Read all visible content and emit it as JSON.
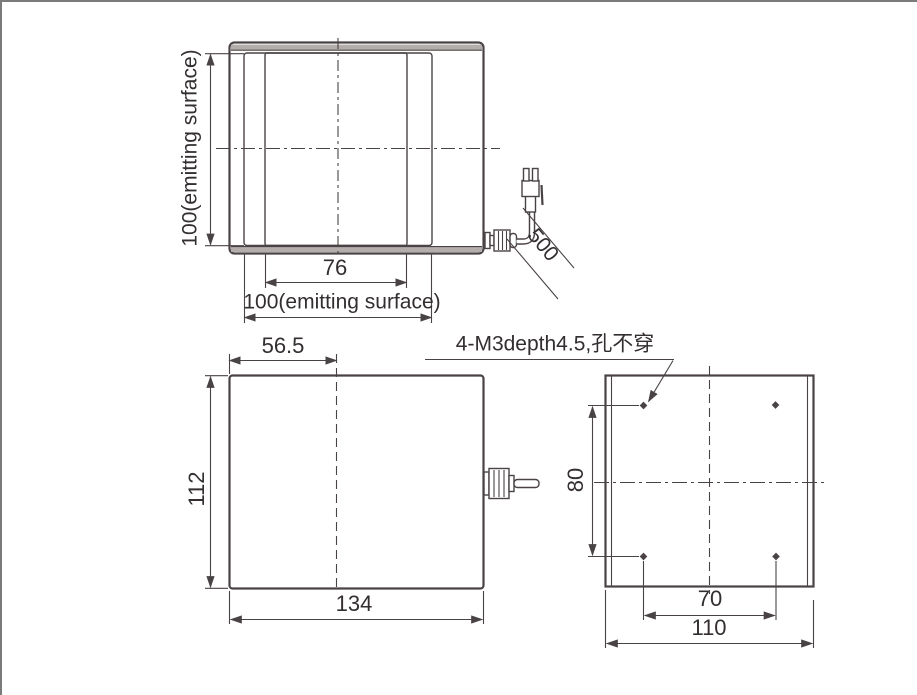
{
  "colors": {
    "line": "#4a4345",
    "band": "#b3adab",
    "text": "#332e31",
    "frame": "#7b7b7b"
  },
  "front_view": {
    "emitting_height_label": "100(emitting surface)",
    "inner_width_label": "76",
    "emitting_width_label": "100(emitting surface)",
    "cable_length_label": "500"
  },
  "side_view": {
    "center_offset_label": "56.5",
    "height_label": "112",
    "width_label": "134"
  },
  "back_view": {
    "mounting_note": "4-M3depth4.5,孔不穿",
    "hole_vertical_pitch_label": "80",
    "hole_horizontal_pitch_label": "70",
    "width_label": "110"
  }
}
